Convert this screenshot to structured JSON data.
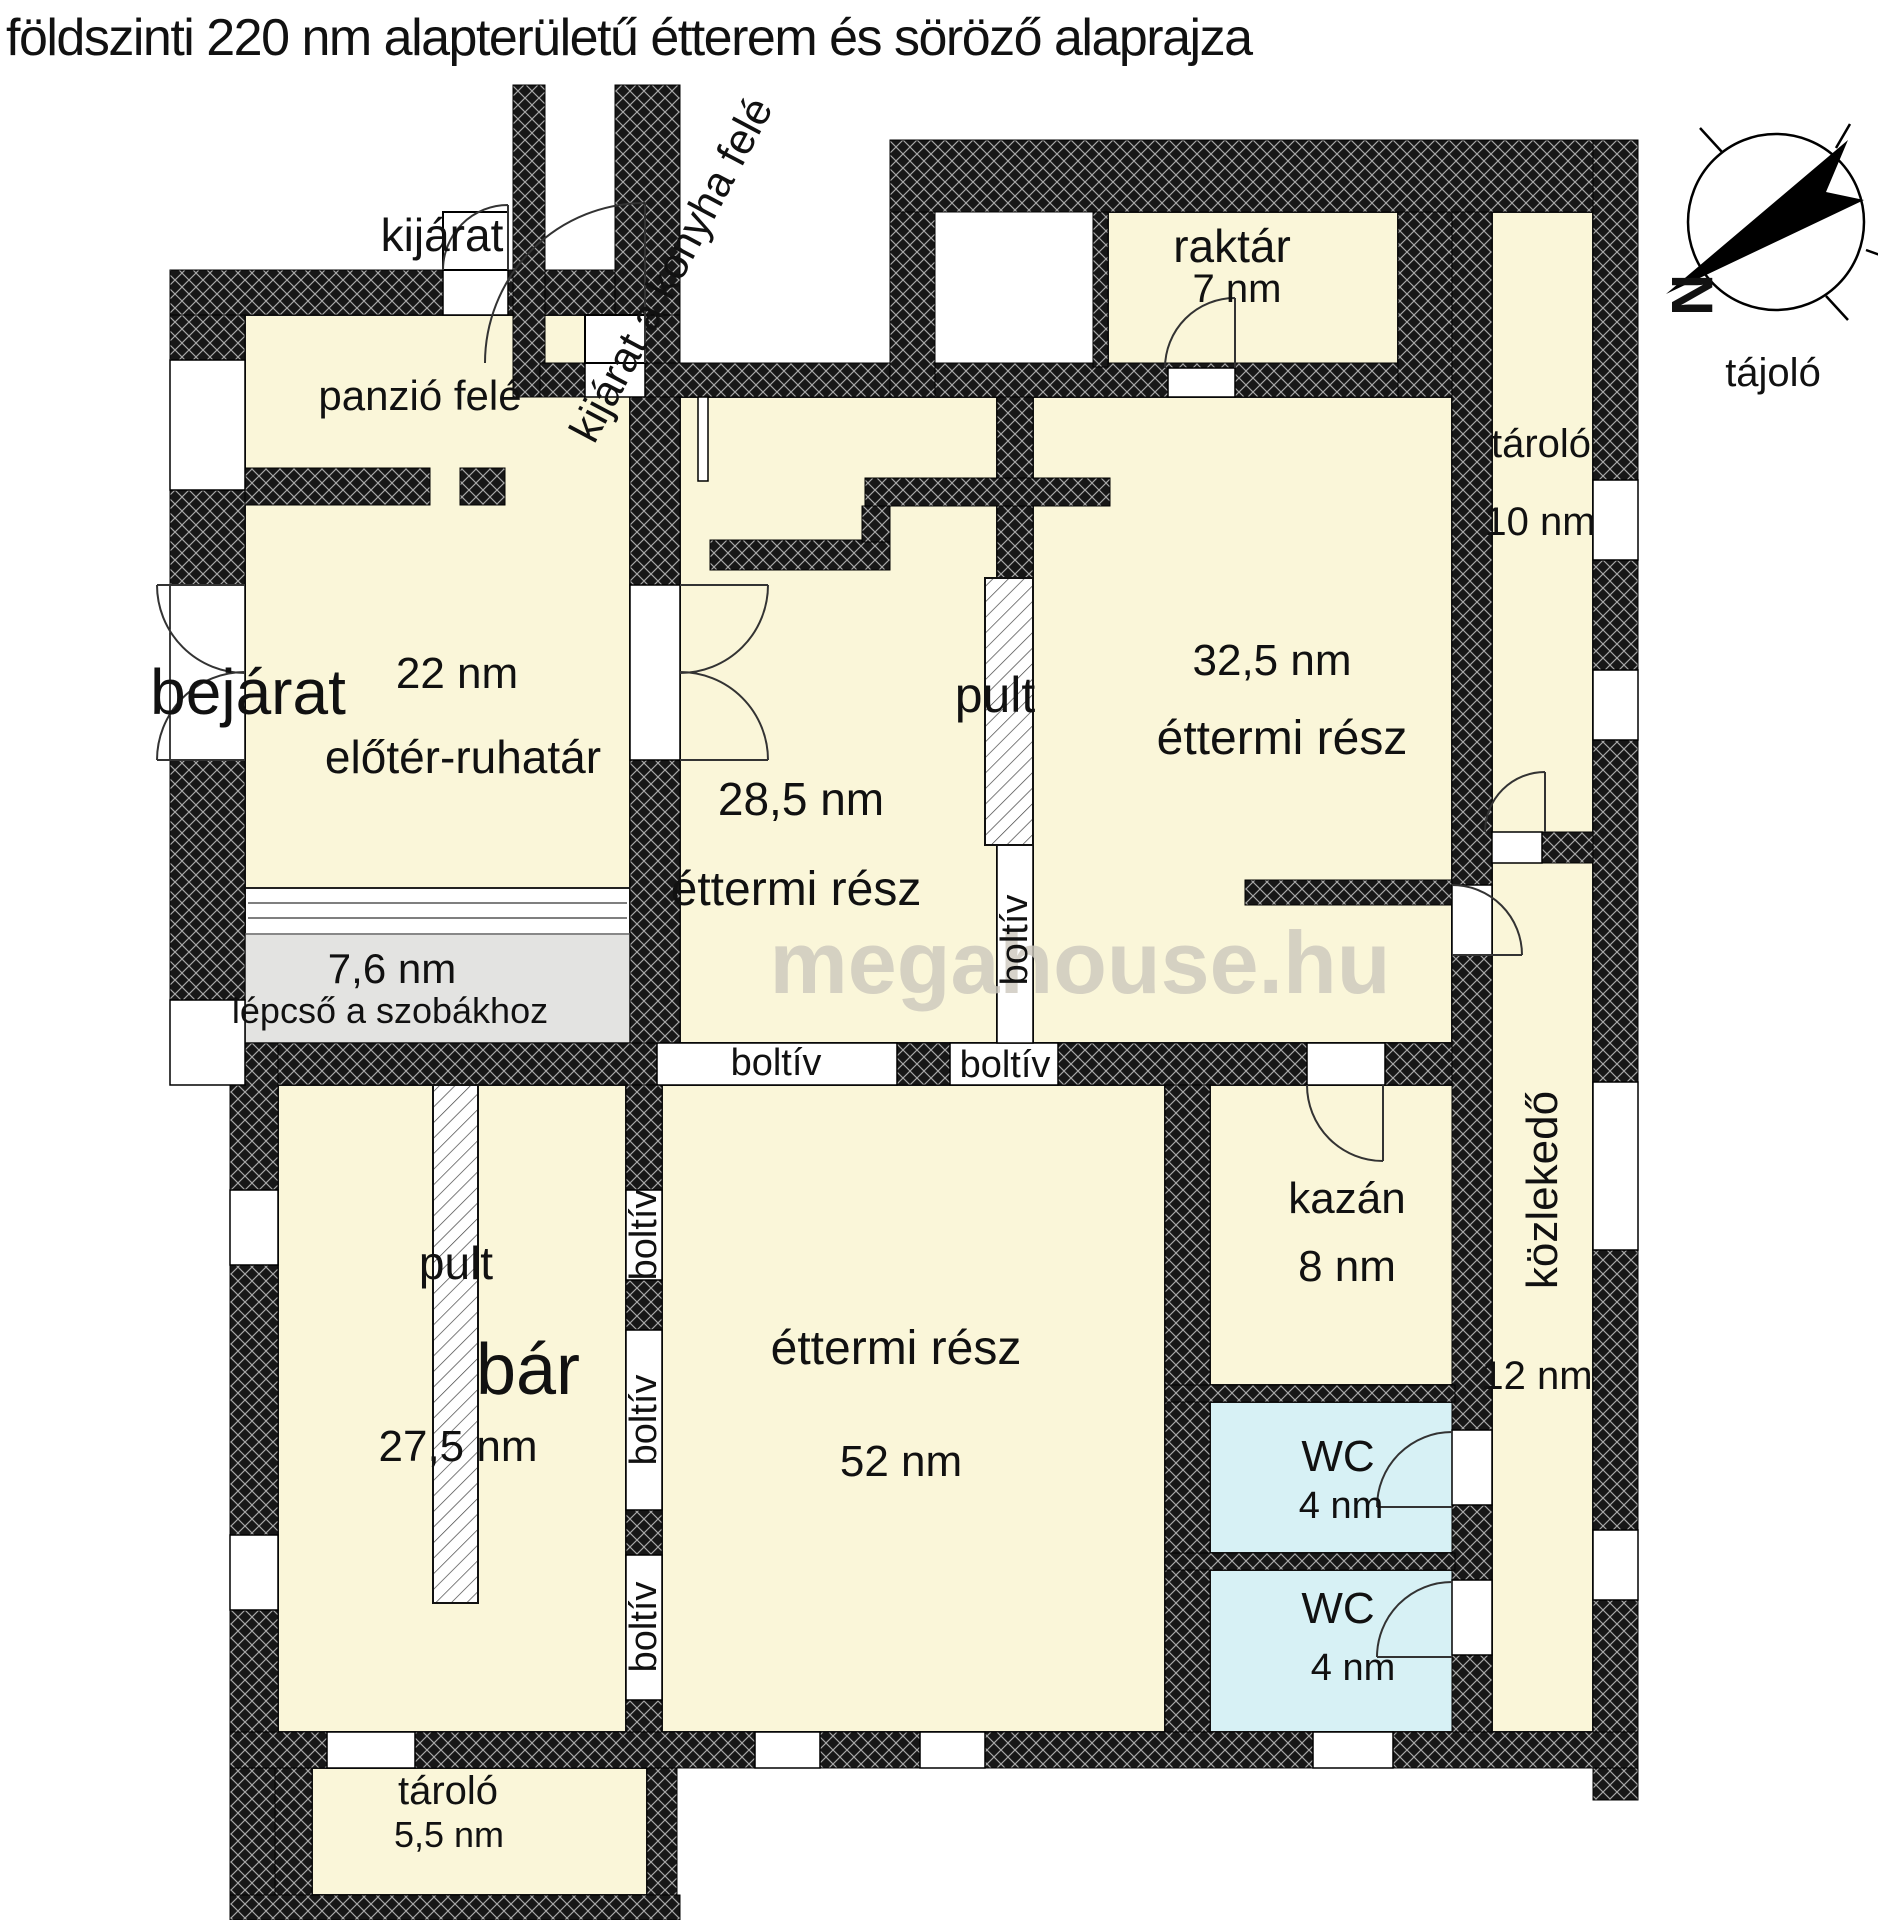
{
  "colors": {
    "room_cream": "#faf6d9",
    "wc_cyan": "#d7f1f5",
    "stairs_gray": "#e3e3e1",
    "wall_black": "#171717",
    "watermark_gray": "#ccc8bd"
  },
  "compass": {
    "label": "tájoló",
    "north_letter": "N"
  },
  "labels": [
    {
      "id": "plan-title",
      "text": "földszinti 220 nm alapterületű étterem és söröző alaprajza",
      "x": 6,
      "y": 38,
      "size": 52,
      "anchor": "left",
      "spacing": -1.5
    },
    {
      "id": "watermark",
      "text": "megahouse.hu",
      "x": 1080,
      "y": 963,
      "size": 88,
      "weight": "bold",
      "color": "#ccc8bd",
      "opacity": 0.8
    },
    {
      "id": "kijarat-label",
      "text": "kijárat",
      "x": 442,
      "y": 235,
      "size": 46
    },
    {
      "id": "panzio-label",
      "text": "panzió felé",
      "x": 420,
      "y": 396,
      "size": 42
    },
    {
      "id": "konyha-exit-label",
      "text": "kijárat a konyha felé",
      "x": 672,
      "y": 270,
      "size": 43,
      "rot": -62
    },
    {
      "id": "raktar-label",
      "text": "raktár",
      "x": 1232,
      "y": 246,
      "size": 46
    },
    {
      "id": "raktar-area",
      "text": "7 nm",
      "x": 1237,
      "y": 289,
      "size": 40
    },
    {
      "id": "tarolo10-label",
      "text": "tároló",
      "x": 1541,
      "y": 444,
      "size": 40
    },
    {
      "id": "tarolo10-area",
      "text": "10 nm",
      "x": 1540,
      "y": 522,
      "size": 40
    },
    {
      "id": "bejarat-label",
      "text": "bejárat",
      "x": 248,
      "y": 692,
      "size": 64
    },
    {
      "id": "eloter-area",
      "text": "22 nm",
      "x": 457,
      "y": 674,
      "size": 44
    },
    {
      "id": "eloter-label",
      "text": "előtér-ruhatár",
      "x": 463,
      "y": 757,
      "size": 46
    },
    {
      "id": "etterem1-area",
      "text": "28,5 nm",
      "x": 801,
      "y": 799,
      "size": 46
    },
    {
      "id": "etterem1-label",
      "text": "éttermi rész",
      "x": 796,
      "y": 890,
      "size": 48
    },
    {
      "id": "pult1-label",
      "text": "pult",
      "x": 995,
      "y": 695,
      "size": 50
    },
    {
      "id": "etterem2-area",
      "text": "32,5 nm",
      "x": 1272,
      "y": 661,
      "size": 44
    },
    {
      "id": "etterem2-label",
      "text": "éttermi rész",
      "x": 1282,
      "y": 739,
      "size": 48
    },
    {
      "id": "lepcso-area",
      "text": "7,6 nm",
      "x": 392,
      "y": 969,
      "size": 42
    },
    {
      "id": "lepcso-label",
      "text": "lépcső a szobákhoz",
      "x": 390,
      "y": 1011,
      "size": 36
    },
    {
      "id": "boltiv-h1",
      "text": "boltív",
      "x": 776,
      "y": 1063,
      "size": 38
    },
    {
      "id": "boltiv-h2",
      "text": "boltív",
      "x": 1005,
      "y": 1065,
      "size": 38
    },
    {
      "id": "boltiv-v0",
      "text": "boltív",
      "x": 1015,
      "y": 940,
      "size": 38,
      "rot": -90
    },
    {
      "id": "pult2-label",
      "text": "pult",
      "x": 456,
      "y": 1263,
      "size": 46
    },
    {
      "id": "bar-label",
      "text": "bár",
      "x": 528,
      "y": 1370,
      "size": 72
    },
    {
      "id": "bar-area",
      "text": "27,5 nm",
      "x": 458,
      "y": 1447,
      "size": 44
    },
    {
      "id": "boltiv-v1",
      "text": "boltív",
      "x": 644,
      "y": 1235,
      "size": 38,
      "rot": -90
    },
    {
      "id": "boltiv-v2",
      "text": "boltív",
      "x": 644,
      "y": 1420,
      "size": 38,
      "rot": -90
    },
    {
      "id": "boltiv-v3",
      "text": "boltív",
      "x": 644,
      "y": 1627,
      "size": 38,
      "rot": -90
    },
    {
      "id": "etterem3-label",
      "text": "éttermi rész",
      "x": 896,
      "y": 1349,
      "size": 48
    },
    {
      "id": "etterem3-area",
      "text": "52 nm",
      "x": 901,
      "y": 1462,
      "size": 44
    },
    {
      "id": "kazan-label",
      "text": "kazán",
      "x": 1347,
      "y": 1199,
      "size": 44
    },
    {
      "id": "kazan-area",
      "text": "8 nm",
      "x": 1347,
      "y": 1267,
      "size": 44
    },
    {
      "id": "kozlekedo-label",
      "text": "közlekedő",
      "x": 1543,
      "y": 1190,
      "size": 44,
      "rot": -90
    },
    {
      "id": "kozlekedo-area",
      "text": "12 nm",
      "x": 1537,
      "y": 1376,
      "size": 40
    },
    {
      "id": "wc1-label",
      "text": "WC",
      "x": 1338,
      "y": 1457,
      "size": 44
    },
    {
      "id": "wc1-area",
      "text": "4 nm",
      "x": 1341,
      "y": 1506,
      "size": 38
    },
    {
      "id": "wc2-label",
      "text": "WC",
      "x": 1338,
      "y": 1609,
      "size": 44
    },
    {
      "id": "wc2-area",
      "text": "4 nm",
      "x": 1353,
      "y": 1668,
      "size": 38
    },
    {
      "id": "tarolo55-label",
      "text": "tároló",
      "x": 448,
      "y": 1791,
      "size": 40
    },
    {
      "id": "tarolo55-area",
      "text": "5,5 nm",
      "x": 449,
      "y": 1835,
      "size": 36
    },
    {
      "id": "tajolo-label",
      "text": "tájoló",
      "x": 1773,
      "y": 373,
      "size": 40
    },
    {
      "id": "compass-north",
      "text": "N",
      "x": 1691,
      "y": 295,
      "size": 58,
      "rot": 90,
      "weight": "bold"
    }
  ]
}
